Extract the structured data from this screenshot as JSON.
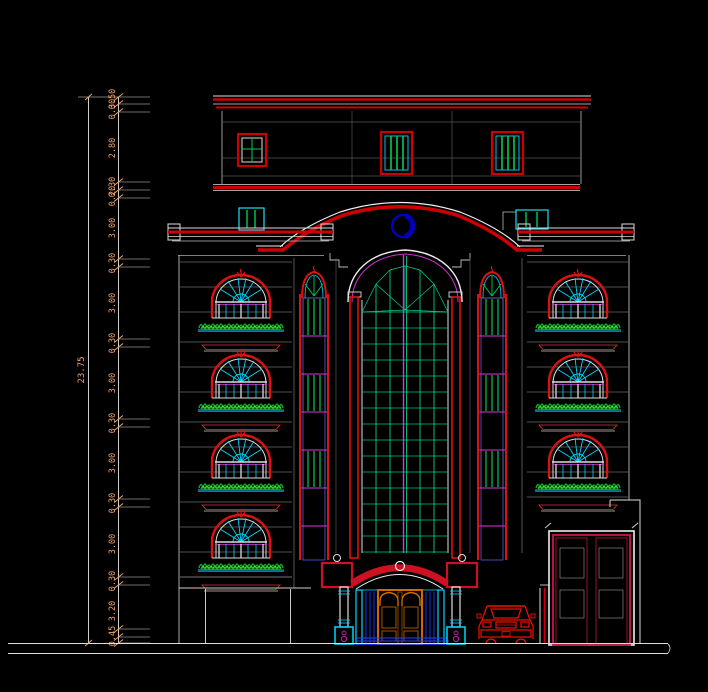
{
  "drawing": {
    "type": "architectural-elevation",
    "description": "CAD front elevation of a multi-storey building, black model-space background",
    "background": "#000000",
    "dimensions": {
      "total": "23.75",
      "chain": [
        {
          "v": "0.50",
          "y": 99
        },
        {
          "v": "0.30",
          "y": 109
        },
        {
          "v": "2.80",
          "y": 148
        },
        {
          "v": "0.30",
          "y": 187
        },
        {
          "v": "0.20",
          "y": 196
        },
        {
          "v": "3.00",
          "y": 228
        },
        {
          "v": "0.30",
          "y": 263
        },
        {
          "v": "3.00",
          "y": 303
        },
        {
          "v": "0.30",
          "y": 343
        },
        {
          "v": "3.00",
          "y": 383
        },
        {
          "v": "0.30",
          "y": 423
        },
        {
          "v": "3.00",
          "y": 463
        },
        {
          "v": "0.30",
          "y": 503
        },
        {
          "v": "3.00",
          "y": 544
        },
        {
          "v": "0.30",
          "y": 581
        },
        {
          "v": "3.20",
          "y": 611
        },
        {
          "v": "0.45",
          "y": 636
        }
      ]
    },
    "colors": {
      "cad_red": "#dd1111",
      "cyan": "#00d5ff",
      "green": "#00cc55",
      "magenta": "#dd33dd",
      "blue": "#2233ff",
      "dark_blue_ornament": "#0000cc",
      "dim_text_orange": "#f0a068",
      "white_line": "#e8e8e8",
      "door_wood_orange": "#cc6a00",
      "gate_crimson": "#d4145a",
      "lattice_olive": "#9a8a28",
      "plant_green": "#11bb22"
    }
  }
}
